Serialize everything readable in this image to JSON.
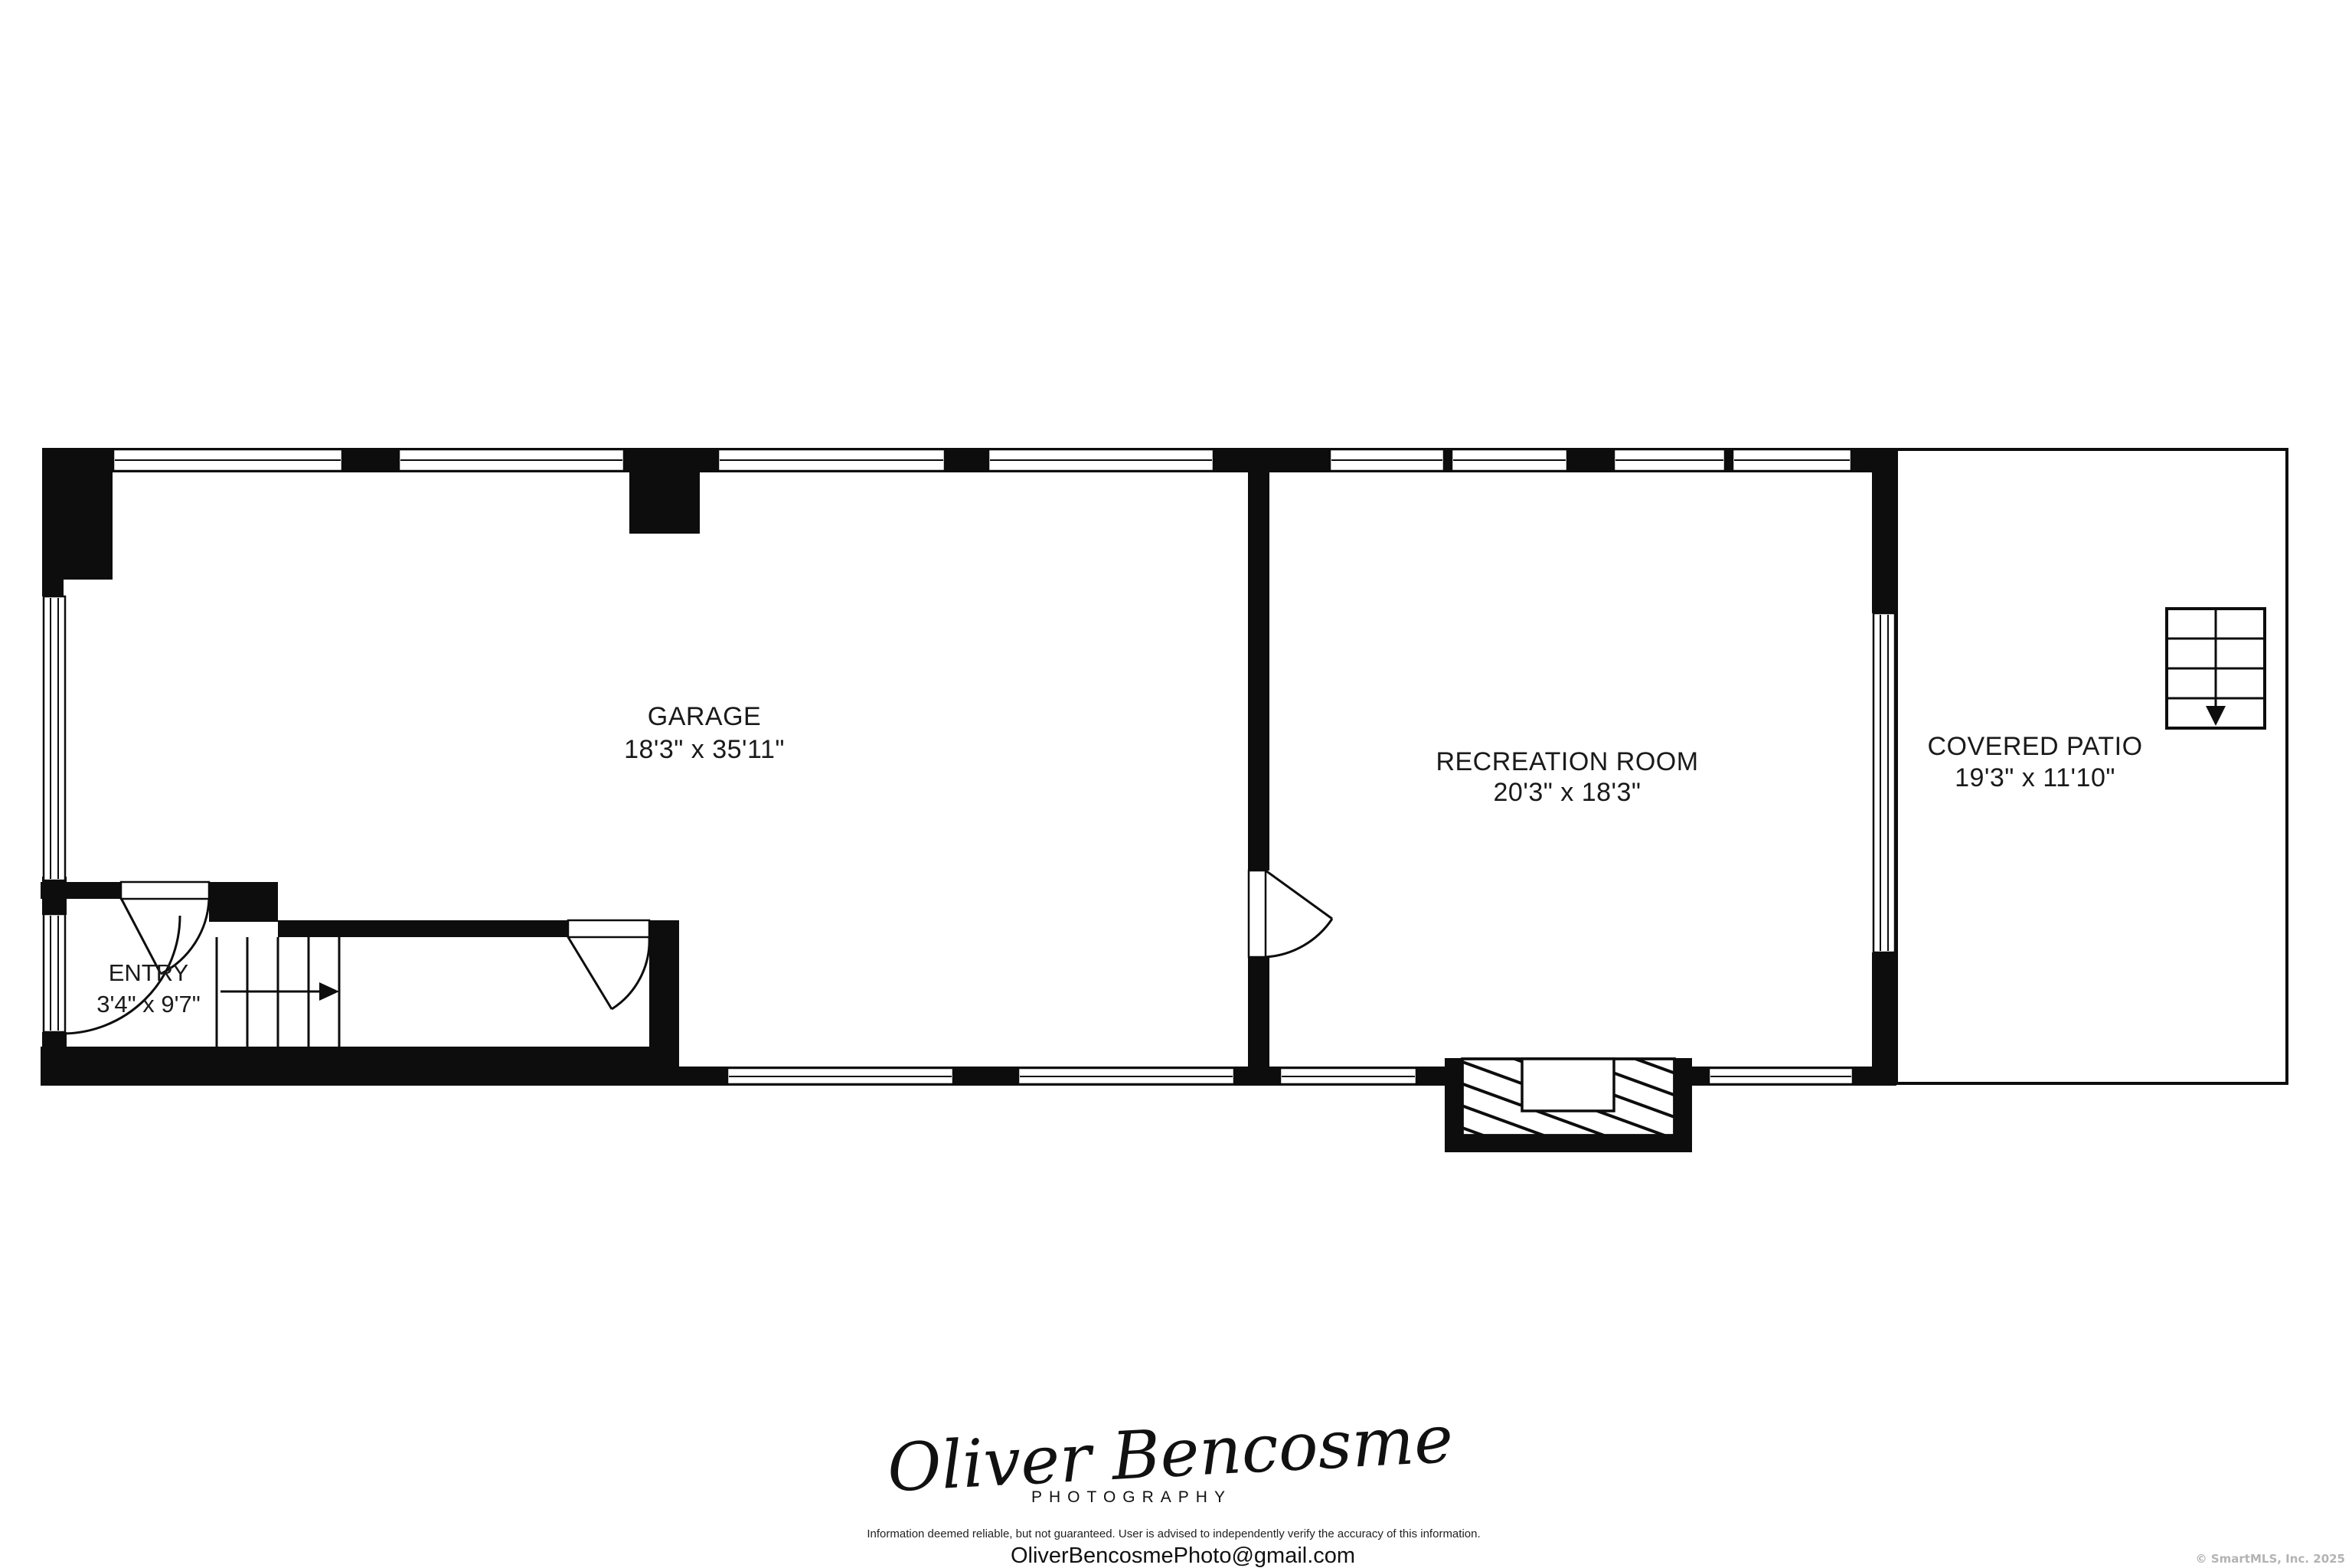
{
  "plan": {
    "rooms": [
      {
        "name": "GARAGE",
        "dims": "18'3\" x 35'11\""
      },
      {
        "name": "RECREATION ROOM",
        "dims": "20'3\" x 18'3\""
      },
      {
        "name": "COVERED PATIO",
        "dims": "19'3\" x 11'10\""
      },
      {
        "name": "ENTRY",
        "dims": "3'4\" x 9'7\""
      }
    ],
    "features": [
      "stairs-up-arrow",
      "exterior-stairs-down-arrow",
      "fireplace",
      "door-swings",
      "windows"
    ]
  },
  "footer": {
    "signature": "Oliver Bencosme",
    "signature_subtitle": "PHOTOGRAPHY",
    "disclaimer": "Information deemed reliable, but not guaranteed. User is advised to independently verify the accuracy of this information.",
    "email": "OliverBencosmePhoto@gmail.com",
    "copyright": "© SmartMLS, Inc.  2025"
  },
  "colors": {
    "wall": "#0d0d0d",
    "background": "#ffffff",
    "label_text": "#1a1a1a",
    "copyright_text": "#b3b3b3"
  }
}
